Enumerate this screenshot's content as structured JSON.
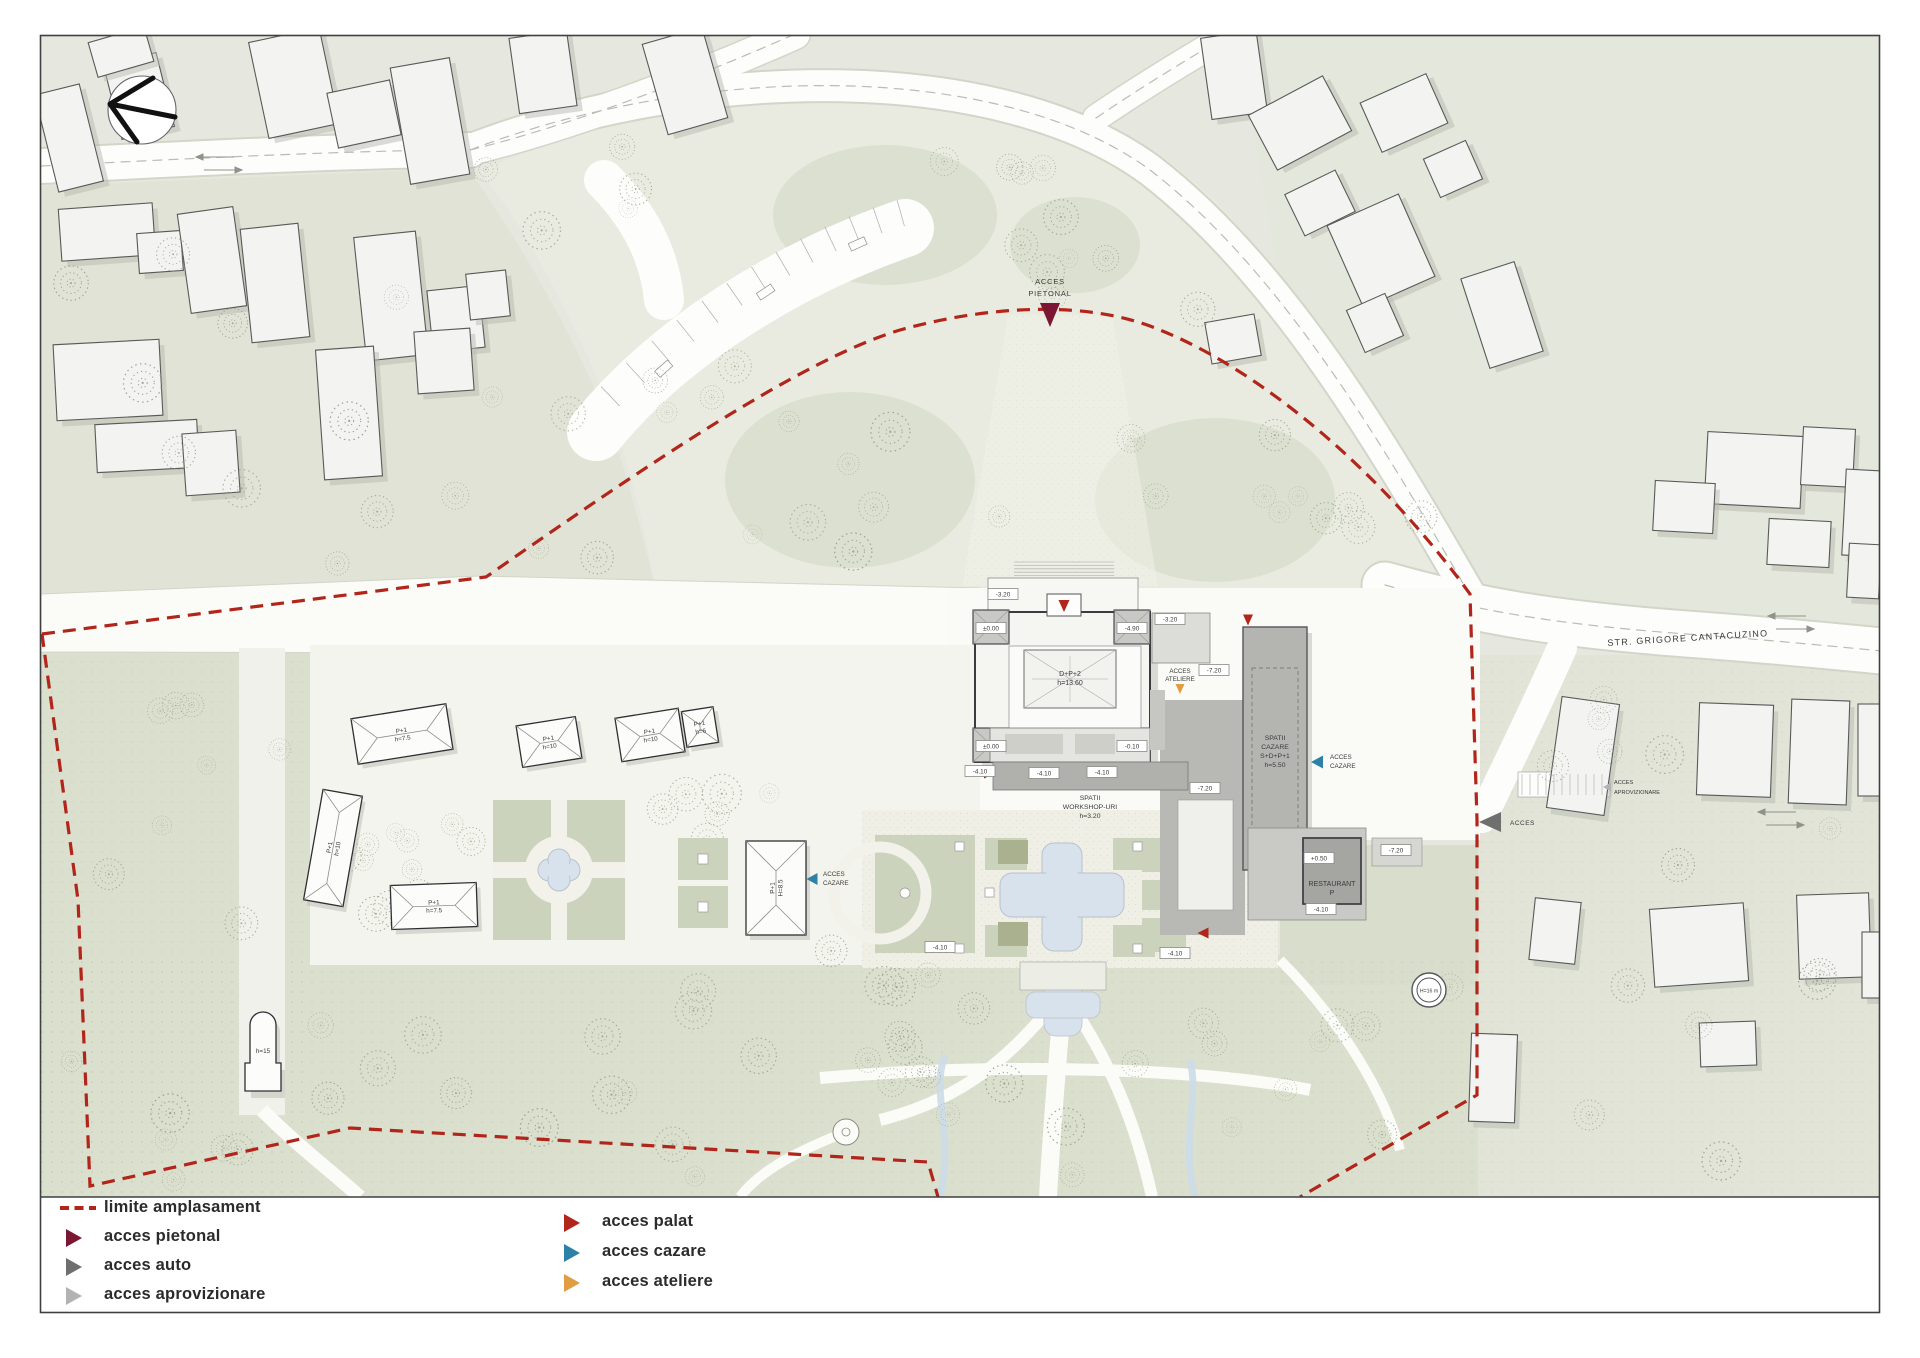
{
  "colors": {
    "boundary": "#b1251a",
    "pietonal": "#7c1733",
    "auto": "#6f6f6f",
    "aprovizionare": "#b3b3b3",
    "palat": "#b1251a",
    "cazare": "#2e81a6",
    "ateliere": "#e09d44",
    "water": "#d8e2ec"
  },
  "legend": {
    "left": [
      {
        "label": "limite amplasament"
      },
      {
        "label": "acces pietonal"
      },
      {
        "label": "acces auto"
      },
      {
        "label": "acces aprovizionare"
      }
    ],
    "right": [
      {
        "label": "acces palat"
      },
      {
        "label": "acces cazare"
      },
      {
        "label": "acces ateliere"
      }
    ]
  },
  "map": {
    "street": "STR. GRIGORE CANTACUZINO",
    "access": {
      "pietonal1": "ACCES",
      "pietonal2": "PIETONAL",
      "ateliere1": "ACCES",
      "ateliere2": "ATELIERE",
      "cazare1": "ACCES",
      "cazare2": "CAZARE",
      "auto": "ACCES",
      "aproviz1": "ACCES",
      "aproviz2": "APROVIZIONARE"
    },
    "palace": {
      "l1": "D+P+2",
      "l2": "h=13.60"
    },
    "workshop": {
      "l1": "SPATII",
      "l2": "WORKSHOP-URI",
      "l3": "h=3.20"
    },
    "cazare_block": {
      "l1": "SPATII",
      "l2": "CAZARE",
      "l3": "S+D+P+1",
      "l4": "h=5.50"
    },
    "restaurant": {
      "l1": "RESTAURANT",
      "l2": "P"
    },
    "tower": "H=16 m",
    "houses": [
      {
        "l1": "P+1",
        "l2": "h=7.5"
      },
      {
        "l1": "P+1",
        "l2": "h=10"
      },
      {
        "l1": "P+1",
        "l2": "h=10"
      },
      {
        "l1": "P+1",
        "l2": "h=6"
      },
      {
        "l1": "P+1",
        "l2": "h=10"
      },
      {
        "l1": "P+1",
        "l2": "h=7.5"
      },
      {
        "l1": "P+1",
        "l2": "H=8.5"
      },
      {
        "l1": "h=15",
        "l2": ""
      }
    ],
    "levels": [
      "-3.20",
      "±0.00",
      "-4.90",
      "±0.00",
      "-0.10",
      "-3.20",
      "-7.20",
      "-7.20",
      "-7.20",
      "-4.10",
      "-4.10",
      "-4.10",
      "-4.10",
      "-4.10",
      "+0.50",
      "-4.10"
    ]
  }
}
